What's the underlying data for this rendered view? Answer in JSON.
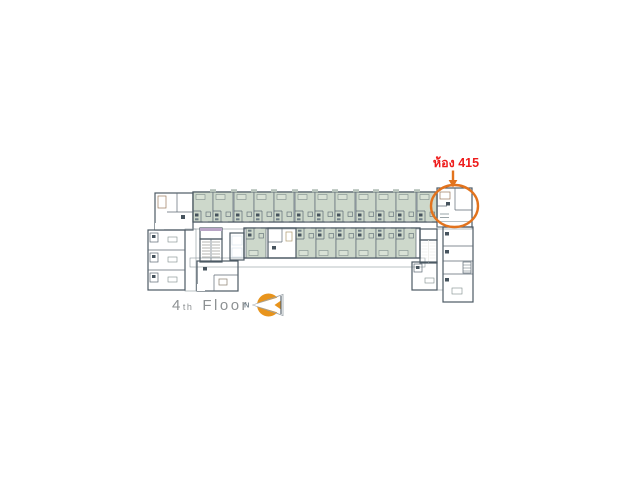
{
  "annotation": {
    "room_label": "ห้อง 415",
    "label_color": "#ee1c1c",
    "marker_color": "#e2731d"
  },
  "footer": {
    "floor_number": "4",
    "floor_suffix": "th",
    "floor_word": "Floor",
    "floor_text_color": "#8d9193",
    "north_label": "N",
    "north_label_color": "#77848e"
  },
  "palette": {
    "wall": "#4d5a64",
    "room_green": "#cdd8cb",
    "room_highlight": "#f2b488",
    "room_tan": "#f5dcae",
    "room_purple": "#d9c6e0",
    "elevator_blue": "#6e96bb",
    "room_brown": "#cec3b6",
    "stair_fill": "#cac3b9",
    "stair_dark": "#9a9a95",
    "corridor": "#f6f6f2",
    "compass_orange": "#e8941c"
  }
}
